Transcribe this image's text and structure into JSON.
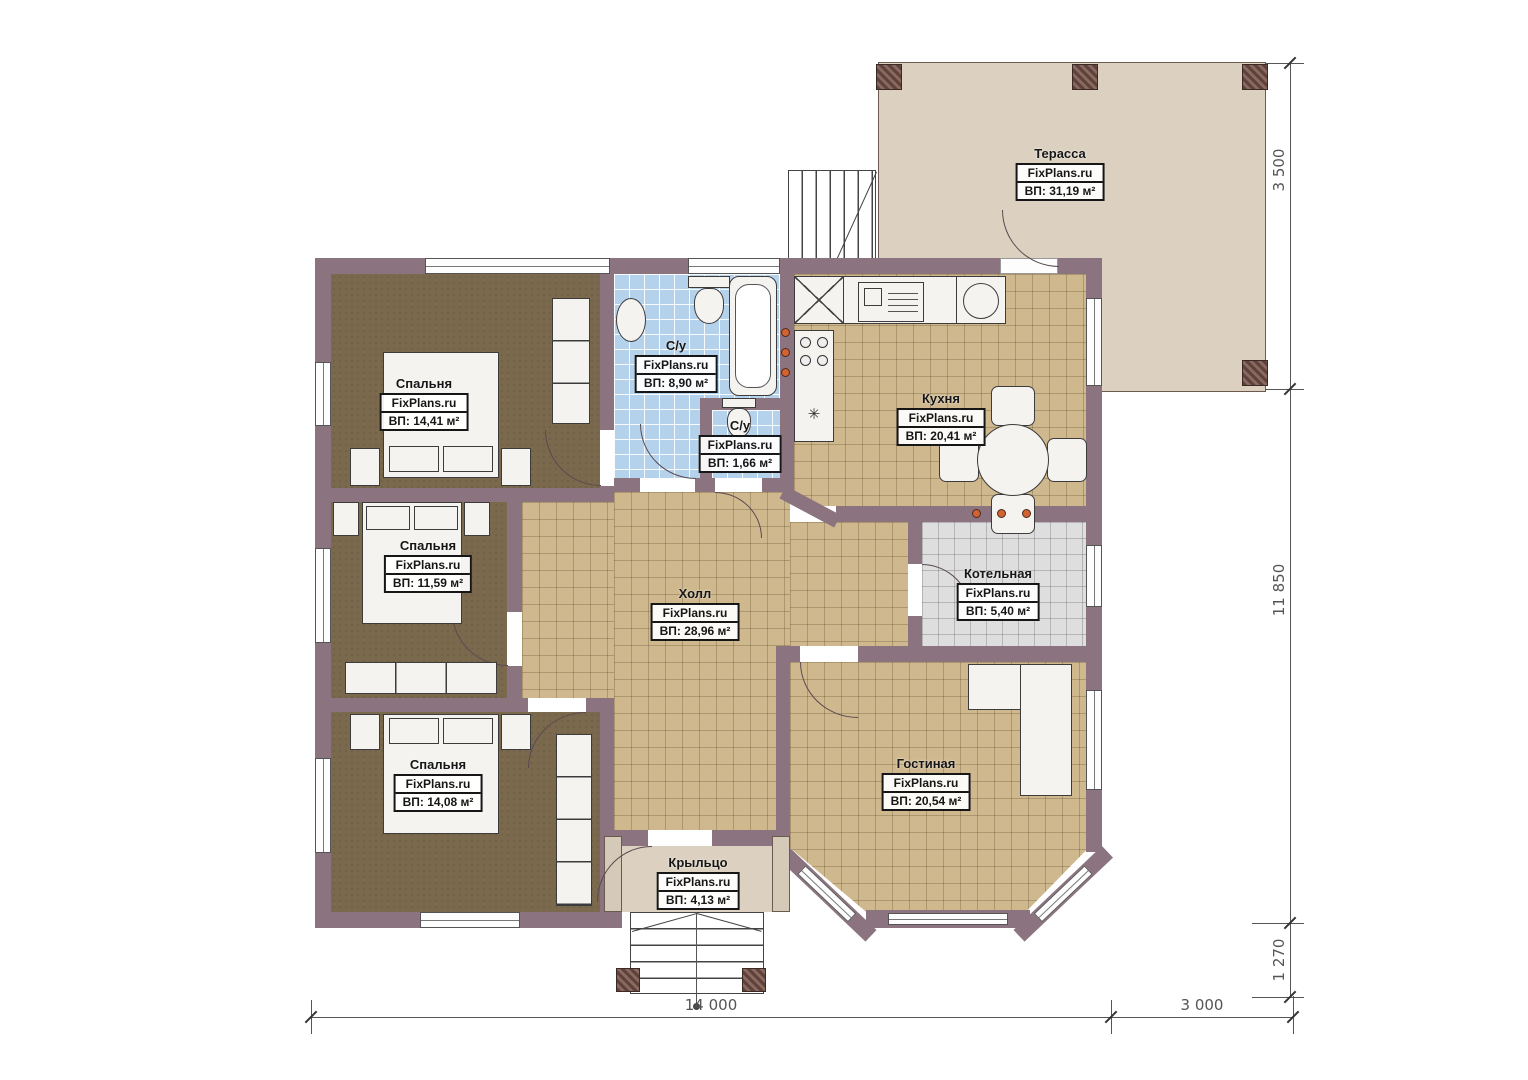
{
  "brand": "FixPlans.ru",
  "rooms": {
    "terrace": {
      "name": "Терасса",
      "area": "ВП: 31,19 м²"
    },
    "bedroom1": {
      "name": "Спальня",
      "area": "ВП: 14,41 м²"
    },
    "bedroom2": {
      "name": "Спальня",
      "area": "ВП: 11,59 м²"
    },
    "bedroom3": {
      "name": "Спальня",
      "area": "ВП: 14,08 м²"
    },
    "bathroom": {
      "name": "С/у",
      "area": "ВП: 8,90 м²"
    },
    "wc": {
      "name": "С/у",
      "area": "ВП: 1,66 м²"
    },
    "kitchen": {
      "name": "Кухня",
      "area": "ВП: 20,41 м²"
    },
    "hall": {
      "name": "Холл",
      "area": "ВП: 28,96 м²"
    },
    "boiler": {
      "name": "Котельная",
      "area": "ВП: 5,40 м²"
    },
    "living": {
      "name": "Гостиная",
      "area": "ВП: 20,54 м²"
    },
    "porch": {
      "name": "Крыльцо",
      "area": "ВП: 4,13 м²"
    }
  },
  "dimensions": {
    "terrace_depth": "3 500",
    "house_depth": "11 850",
    "porch_depth": "1 270",
    "house_width": "14 000",
    "terrace_width": "3 000"
  },
  "icons": {
    "star": "✳"
  },
  "colors": {
    "wall": "#8b7380",
    "floor_tile": "#cfb88e",
    "floor_wood": "#7b694e",
    "bath_tile": "#b5d2ed",
    "terrace": "#dcd1c0",
    "accent": "#d2622f"
  }
}
